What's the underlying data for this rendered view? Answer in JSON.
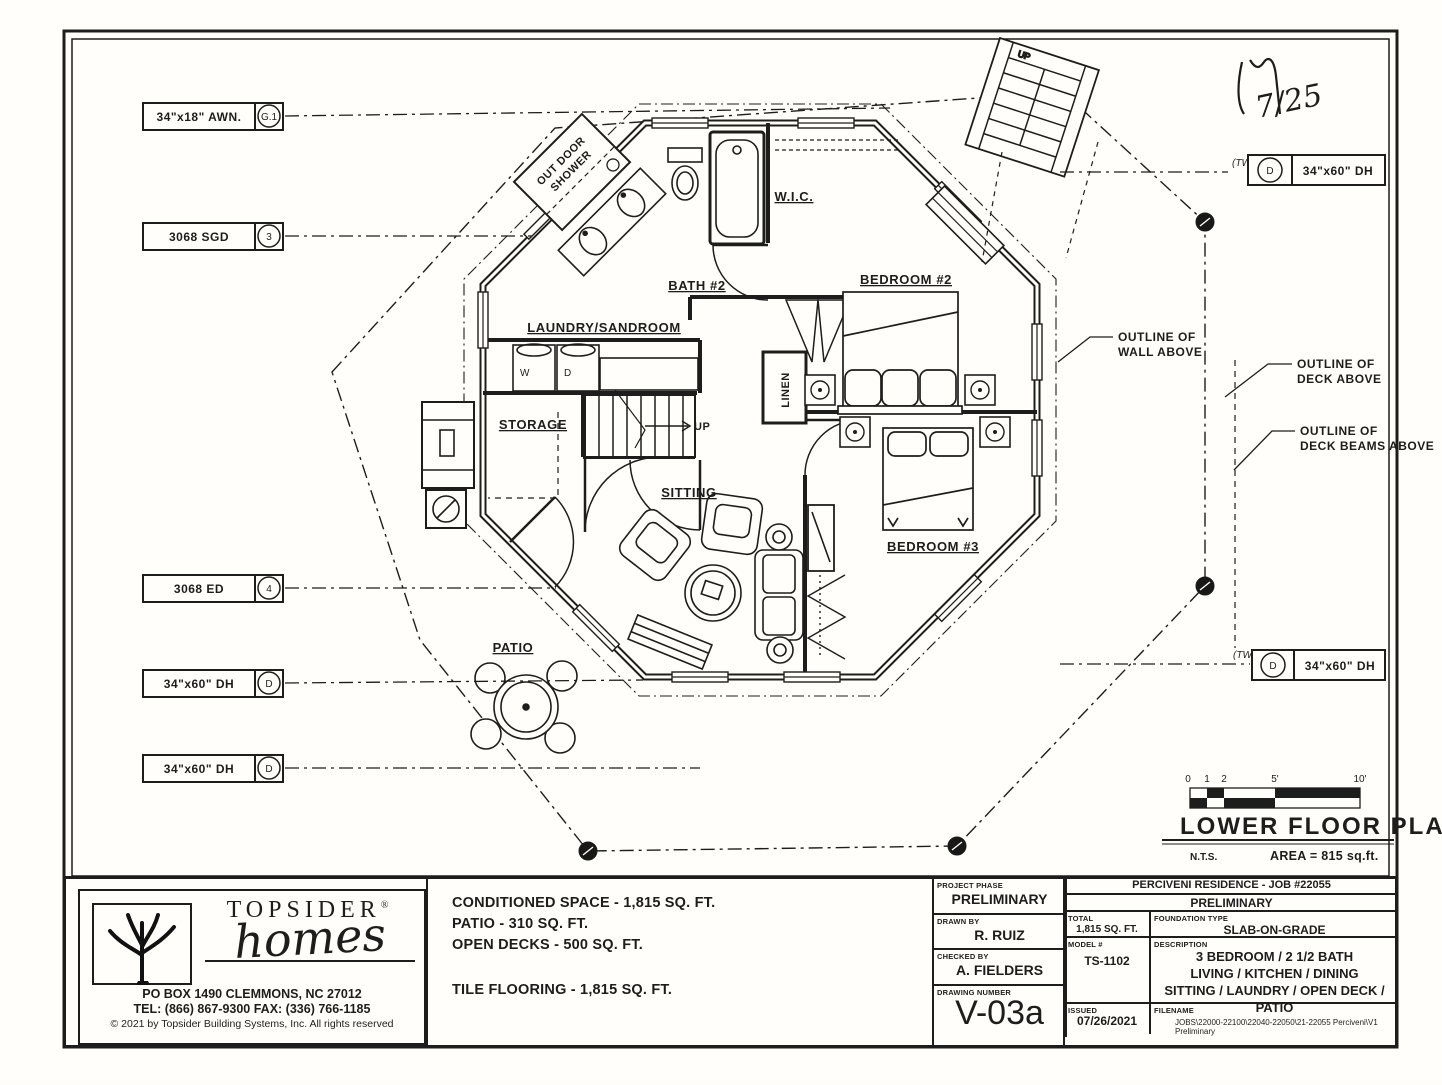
{
  "plan": {
    "rooms": {
      "bath2": "BATH #2",
      "wic": "W.I.C.",
      "laundry": "LAUNDRY/SANDROOM",
      "storage": "STORAGE",
      "sitting": "SITTING",
      "bedroom2": "BEDROOM #2",
      "bedroom3": "BEDROOM #3",
      "linen": "LINEN",
      "patio": "PATIO",
      "outdoor_shower_line1": "OUT DOOR",
      "outdoor_shower_line2": "SHOWER",
      "up_interior": "UP",
      "up_exterior": "UP",
      "washer": "W",
      "dryer": "D"
    },
    "callouts_left": [
      {
        "label": "34\"x18\" AWN.",
        "symbol": "G.1"
      },
      {
        "label": "3068 SGD",
        "symbol": "3"
      },
      {
        "label": "3068 ED",
        "symbol": "4"
      },
      {
        "label": "34\"x60\" DH",
        "symbol": "D"
      },
      {
        "label": "34\"x60\" DH",
        "symbol": "D"
      }
    ],
    "callouts_right": [
      {
        "prefix": "(TWO)",
        "symbol": "D",
        "label": "34\"x60\" DH"
      },
      {
        "prefix": "(TWO)",
        "symbol": "D",
        "label": "34\"x60\" DH"
      }
    ],
    "annotations": [
      {
        "line1": "OUTLINE OF",
        "line2": "WALL ABOVE"
      },
      {
        "line1": "OUTLINE OF",
        "line2": "DECK ABOVE"
      },
      {
        "line1": "OUTLINE OF",
        "line2": "DECK BEAMS ABOVE"
      }
    ],
    "handwritten_mark": "7/25"
  },
  "scale_block": {
    "ticks": [
      "0",
      "1",
      "2",
      "5'",
      "10'"
    ],
    "title": "LOWER FLOOR PLAN",
    "nts": "N.T.S.",
    "area": "AREA = 815 sq.ft."
  },
  "title_block": {
    "company": {
      "name": "TOPSIDER",
      "reg": "®",
      "script": "homes",
      "address": "PO BOX 1490 CLEMMONS, NC  27012",
      "phone": "TEL:  (866) 867-9300 FAX:  (336) 766-1185",
      "copyright": "© 2021 by Topsider Building Systems, Inc. All rights reserved"
    },
    "areas": {
      "line1": "CONDITIONED SPACE - 1,815 SQ. FT.",
      "line2": "PATIO - 310 SQ. FT.",
      "line3": "OPEN DECKS - 500 SQ. FT.",
      "line4": "TILE FLOORING - 1,815 SQ. FT."
    },
    "phase": {
      "label": "PROJECT PHASE",
      "value": "PRELIMINARY",
      "drawn_label": "DRAWN BY",
      "drawn": "R. RUIZ",
      "checked_label": "CHECKED BY",
      "checked": "A. FIELDERS",
      "number_label": "DRAWING NUMBER",
      "number": "V-03a"
    },
    "project": {
      "title": "PERCIVENI RESIDENCE - JOB #22055",
      "phase": "PRELIMINARY",
      "total_label": "TOTAL",
      "total": "1,815 SQ. FT.",
      "foundation_label": "FOUNDATION TYPE",
      "foundation": "SLAB-ON-GRADE",
      "model_label": "MODEL #",
      "model": "TS-1102",
      "desc_label": "DESCRIPTION",
      "desc1": "3 BEDROOM / 2 1/2 BATH",
      "desc2": "LIVING / KITCHEN / DINING",
      "desc3": "SITTING  / LAUNDRY / OPEN DECK / PATIO",
      "issued_label": "ISSUED",
      "issued": "07/26/2021",
      "file_label": "FILENAME",
      "file": "JOBS\\22000-22100\\22040-22050\\21-22055 Perciveni\\V1 Preliminary"
    }
  }
}
